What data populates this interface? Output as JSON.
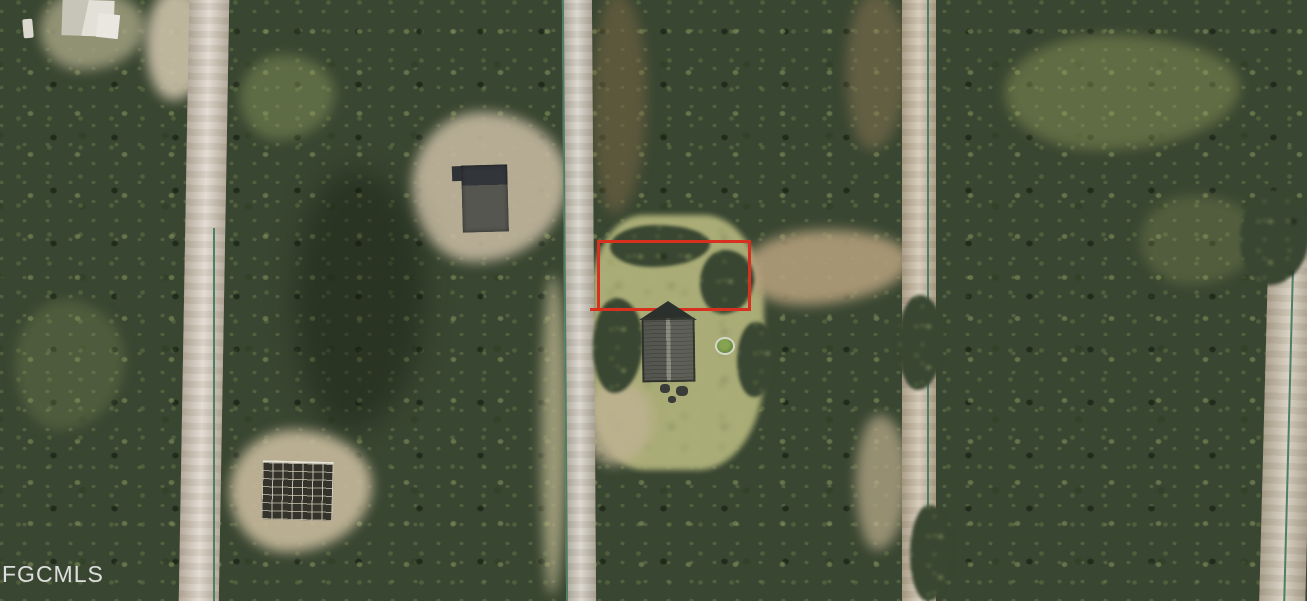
{
  "watermark": {
    "text": "FGCMLS"
  },
  "annotation": {
    "lot_boundary": {
      "label": "highlighted lot boundary",
      "color": "#d8301f",
      "x": 597,
      "y": 240,
      "width": 154,
      "height": 71
    },
    "survey_line_color": "#4d7f66"
  },
  "palette": {
    "boundary": "#d8301f",
    "surveyLine": "#4d7f66",
    "forestBase": "#394631",
    "roadDirtLeft": "#d5cabc",
    "roadPaved": "#c9c4b8",
    "roadDirtRight": "#c3b49a",
    "roadEdgeRight": "#c6bba6",
    "grassLot": "#a9ac76",
    "dirtTrail": "#b19d7a",
    "sandClearing": "#c4b79a",
    "roofDark": "#55564f",
    "roofOutbuilding": "#32363a",
    "poolWater": "#66883e",
    "watermarkColor": "rgba(255,255,255,0.82)"
  },
  "features": {
    "lot": "vacant grass lot outlined in red",
    "roads": [
      "left dirt road",
      "center road with survey line",
      "right dirt road with survey line",
      "far-right edge road"
    ],
    "buildings": [
      "partial house at top-left",
      "gray-roof outbuilding",
      "main house with gabled roof",
      "house under construction (framing)"
    ],
    "pool": "round above-ground pool"
  }
}
